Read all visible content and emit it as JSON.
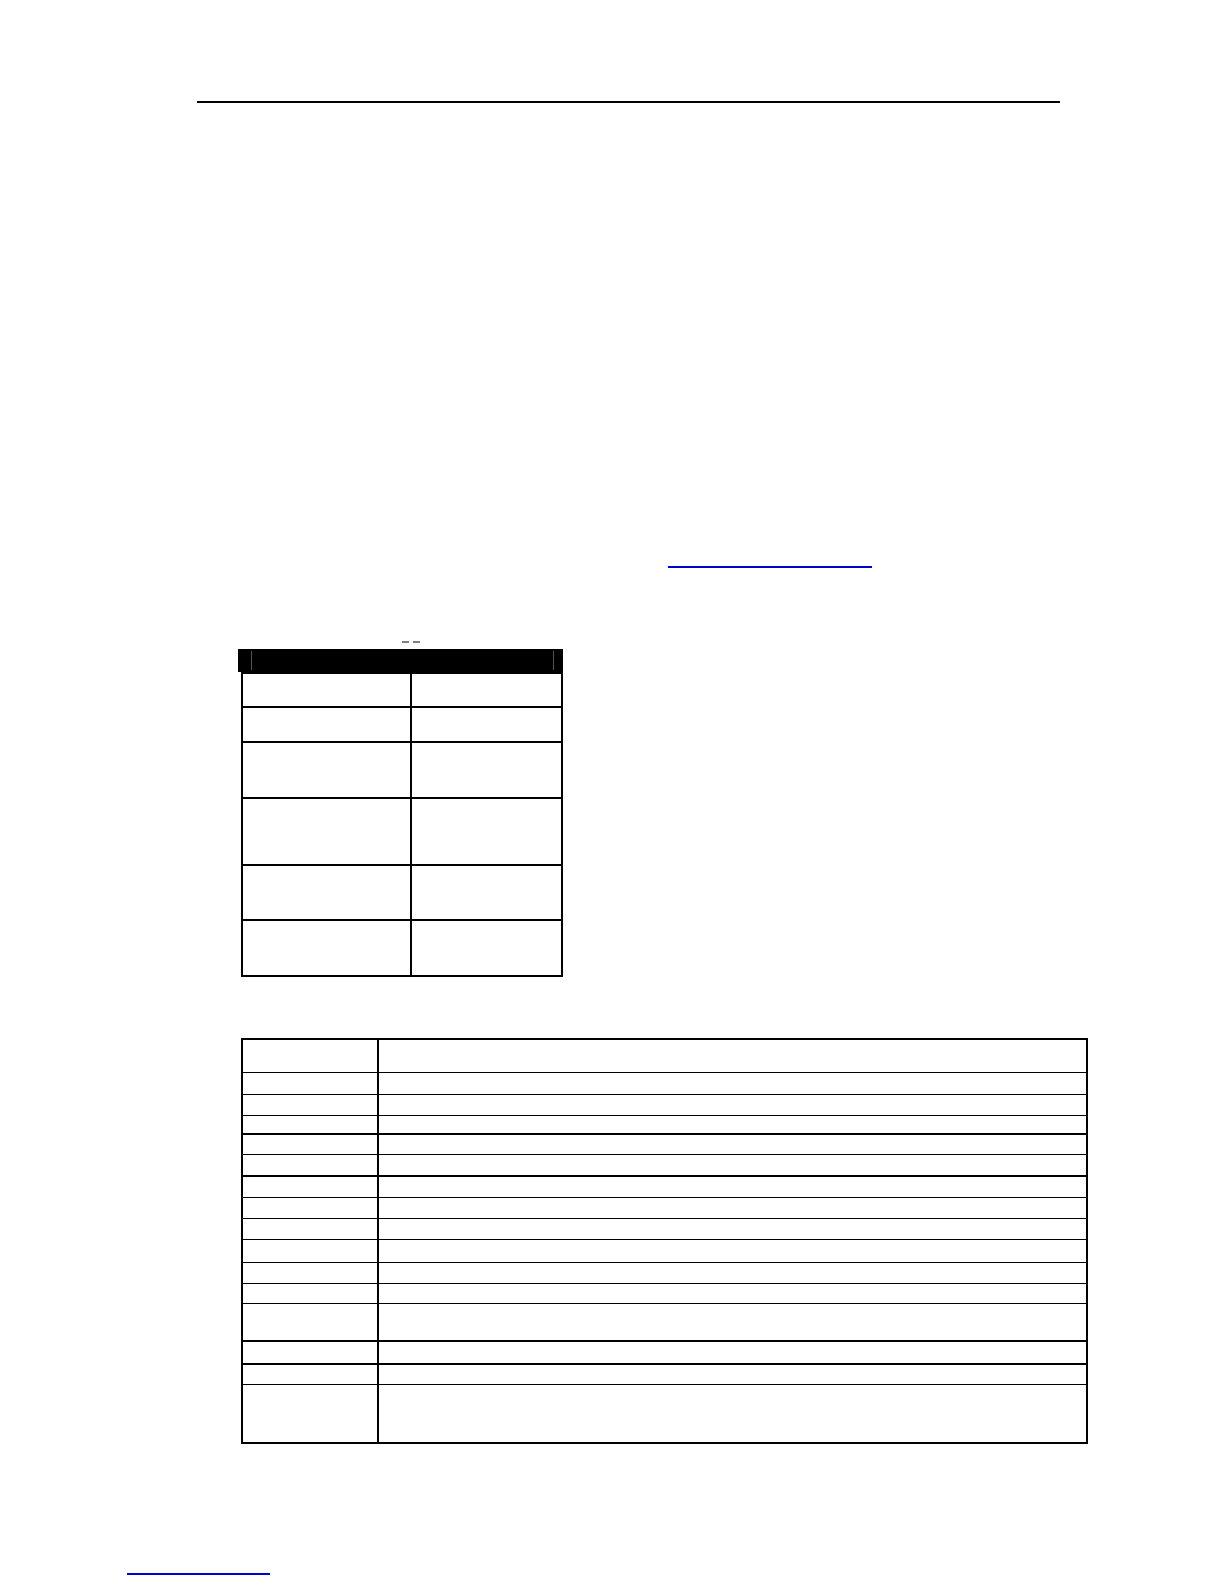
{
  "note": "Rendered document page; body text layer is not visible. Only rules, table grids, a black table-header band, two tiny gray caption dashes and two blue hyperlink underlines are rendered. No legible text appears anywhere on the page.",
  "page": {
    "width": 1225,
    "height": 1585,
    "background": "#ffffff"
  },
  "colors": {
    "rule": "#000000",
    "table_border": "#000000",
    "table_header_fill": "#000000",
    "header_tick": "#555555",
    "link_underline": "#0000cc",
    "caption_dash": "#808080"
  },
  "top_rule": {
    "x": 197,
    "y": 101,
    "w": 863,
    "h": 2
  },
  "inline_link": {
    "x": 668,
    "y": 566,
    "w": 204,
    "h": 2,
    "visible_text": ""
  },
  "footer_link": {
    "x": 127,
    "y": 1573,
    "w": 143,
    "h": 2,
    "visible_text": ""
  },
  "caption_dashes": [
    {
      "x": 402,
      "y": 641,
      "w": 7,
      "h": 2
    },
    {
      "x": 413,
      "y": 641,
      "w": 7,
      "h": 2
    }
  ],
  "spec_table": {
    "columns": 2,
    "visible_text": "",
    "header_bar": {
      "x": 238,
      "y": 649,
      "w": 325,
      "h": 23
    },
    "header_ticks_x": [
      13,
      315
    ],
    "grid": {
      "x": 241,
      "y": 672,
      "w": 322,
      "h": 305
    },
    "col_split": 169,
    "row_heights": [
      34,
      35,
      56,
      67,
      55,
      54
    ],
    "thick_after_rows": [
      1,
      2,
      3,
      4,
      5
    ],
    "row_border": 2
  },
  "detail_table": {
    "columns": 2,
    "visible_text": "",
    "grid": {
      "x": 241,
      "y": 1038,
      "w": 847,
      "h": 406
    },
    "col_split": 136,
    "row_heights": [
      33,
      22,
      21,
      19,
      20,
      22,
      21,
      21,
      21,
      23,
      21,
      20,
      38,
      23,
      20,
      57
    ],
    "thick_after_rows": [
      4,
      6,
      13,
      14
    ],
    "row_border": 1
  }
}
